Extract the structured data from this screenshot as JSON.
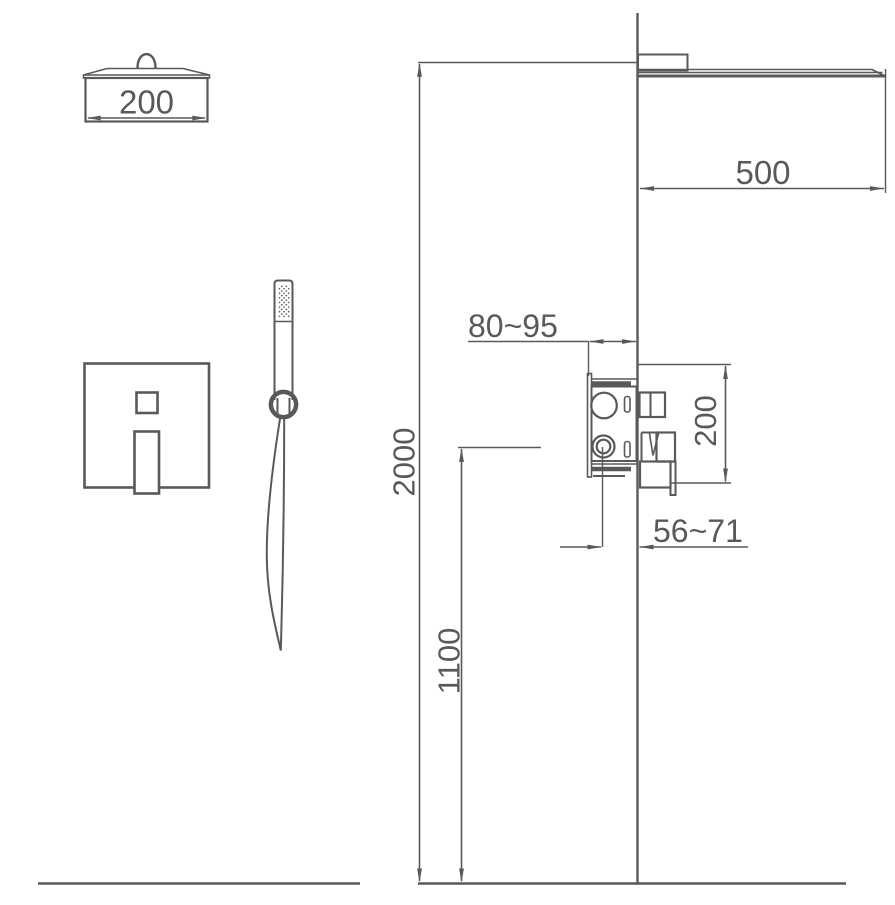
{
  "drawing": {
    "line_color": "#58595b",
    "background_color": "#ffffff"
  },
  "dims": {
    "head_width": "200",
    "arm_projection": "500",
    "shower_height": "2000",
    "mixer_height": "1100",
    "rough_in_depth": "80~95",
    "trim_height": "200",
    "trim_projection": "56~71"
  }
}
